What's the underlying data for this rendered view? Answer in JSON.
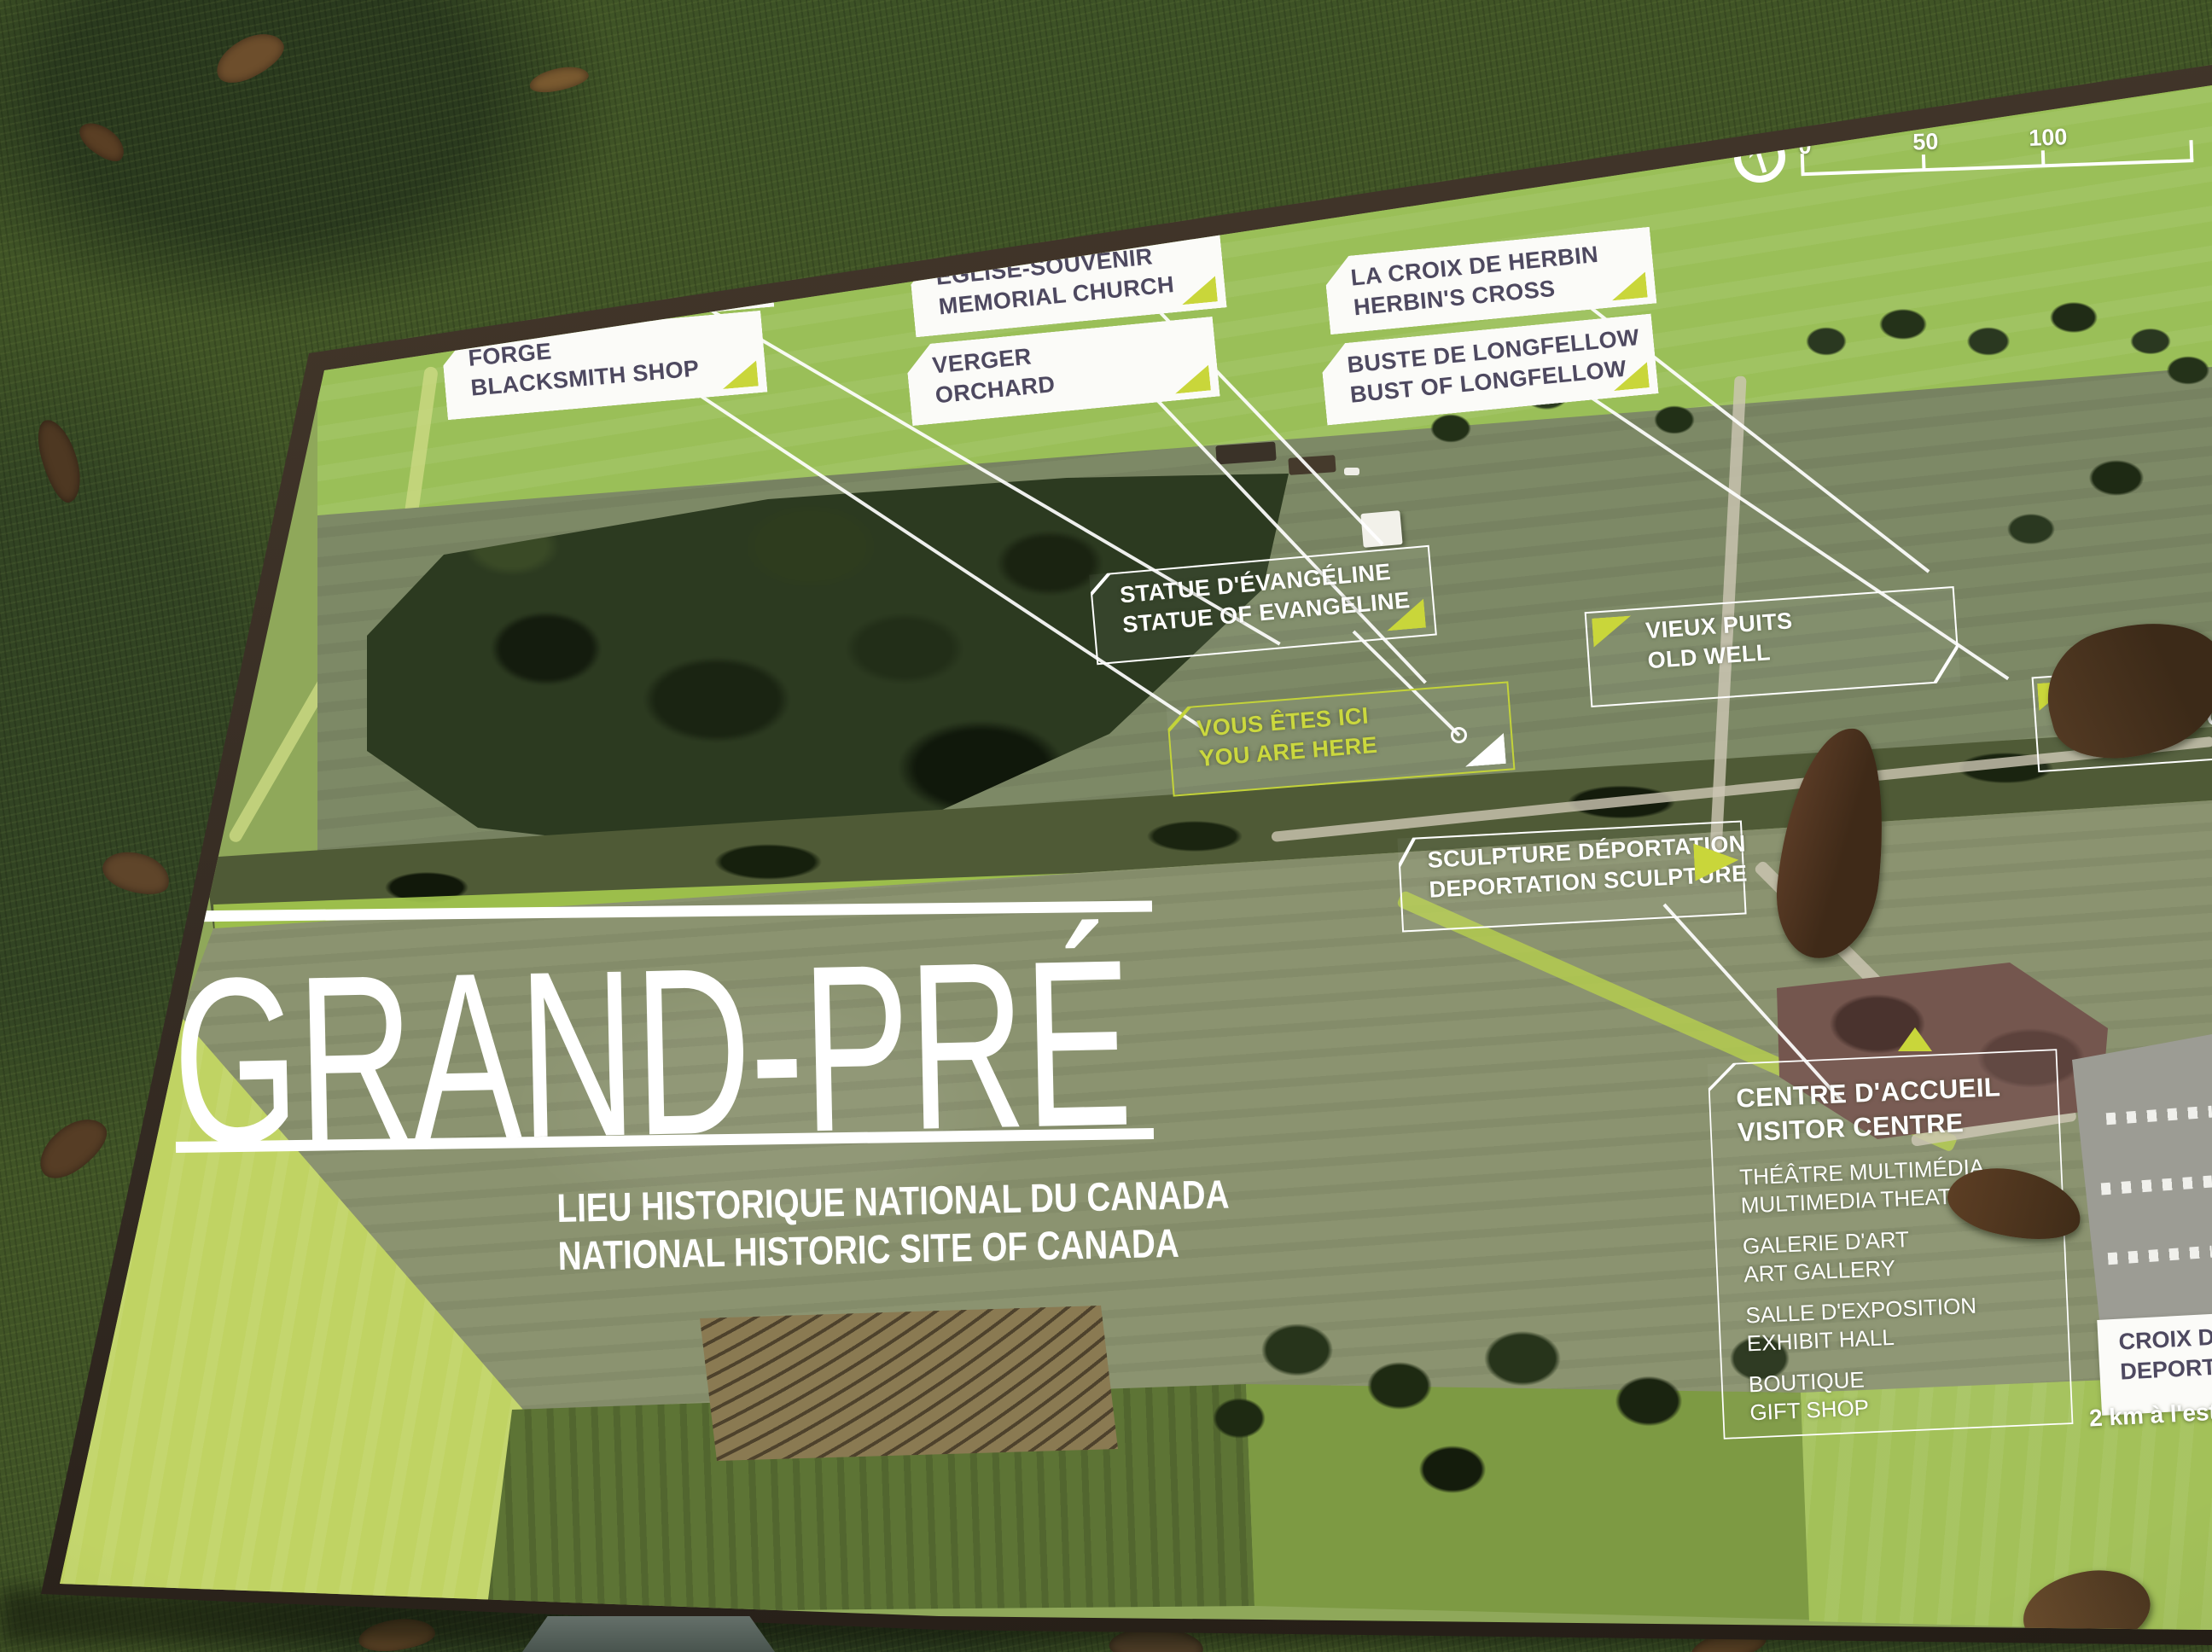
{
  "sign": {
    "title": "GRAND-PRÉ",
    "subtitle_fr": "LIEU HISTORIQUE NATIONAL DU CANADA",
    "subtitle_en": "NATIONAL HISTORIC SITE OF CANADA",
    "compass_label": "N",
    "scale_ticks": [
      "0",
      "50",
      "100"
    ],
    "callouts": [
      {
        "fr": "POTAGER",
        "en": "KITCHEN GARDEN"
      },
      {
        "fr": "FORGE",
        "en": "BLACKSMITH SHOP"
      },
      {
        "fr": "ÉGLISE-SOUVENIR",
        "en": "MEMORIAL CHURCH"
      },
      {
        "fr": "VERGER",
        "en": "ORCHARD"
      },
      {
        "fr": "LA CROIX DE HERBIN",
        "en": "HERBIN'S CROSS"
      },
      {
        "fr": "BUSTE DE LONGFELLOW",
        "en": "BUST OF LONGFELLOW"
      },
      {
        "fr": "STATUE D'ÉVANGÉLINE",
        "en": "STATUE OF EVANGELINE"
      },
      {
        "fr": "VOUS ÊTES ICI",
        "en": "YOU ARE HERE"
      },
      {
        "fr": "VIEUX PUITS",
        "en": "OLD WELL"
      },
      {
        "fr": "CIMETIÈRE",
        "en": "ACADIAN CEMETERY"
      },
      {
        "fr": "SCULPTURE DÉPORTATION",
        "en": "DEPORTATION SCULPTURE"
      }
    ],
    "visitor_centre": {
      "title_fr": "CENTRE D'ACCUEIL",
      "title_en": "VISITOR CENTRE",
      "items": [
        {
          "fr": "THÉÂTRE MULTIMÉDIA",
          "en": "MULTIMEDIA THEATRE"
        },
        {
          "fr": "GALERIE D'ART",
          "en": "ART GALLERY"
        },
        {
          "fr": "SALLE D'EXPOSITION",
          "en": "EXHIBIT HALL"
        },
        {
          "fr": "BOUTIQUE",
          "en": "GIFT SHOP"
        }
      ]
    },
    "deportation_cross": {
      "fr": "CROIX DE LA DÉ",
      "en": "DEPORTATION C",
      "distance": "2 km à l'est/2"
    }
  },
  "colors": {
    "accent_yellow": "#c9d63a",
    "callout_text": "#4e4960",
    "callout_bg": "#fbfbf8",
    "white": "#ffffff"
  }
}
